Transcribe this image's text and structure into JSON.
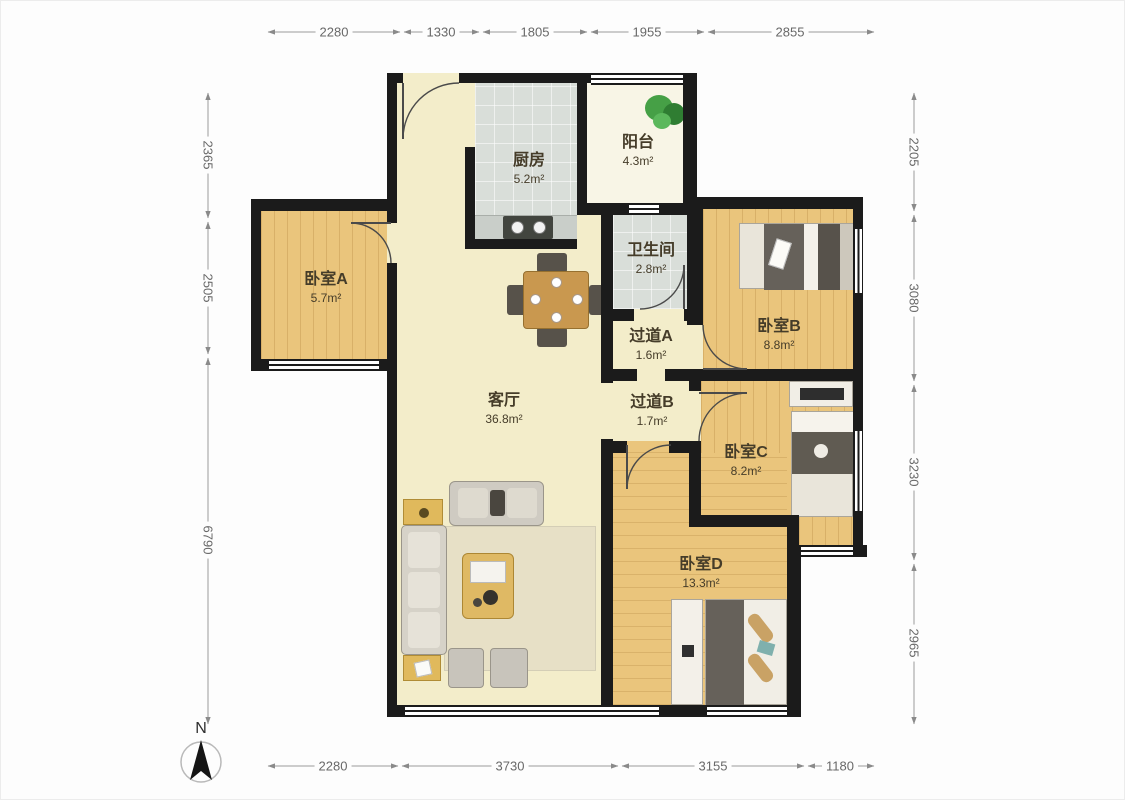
{
  "title": "apartment-floor-plan",
  "compass": {
    "label": "N"
  },
  "dimensions": {
    "top": [
      "2280",
      "1330",
      "1805",
      "1955",
      "2855"
    ],
    "bottom": [
      "2280",
      "3730",
      "3155",
      "1180"
    ],
    "left": [
      "2365",
      "2505",
      "6790"
    ],
    "right": [
      "2205",
      "3080",
      "3230",
      "2965"
    ]
  },
  "rooms": {
    "living": {
      "name": "客厅",
      "area": "36.8m²"
    },
    "kitchen": {
      "name": "厨房",
      "area": "5.2m²"
    },
    "balcony": {
      "name": "阳台",
      "area": "4.3m²"
    },
    "bathroom": {
      "name": "卫生间",
      "area": "2.8m²"
    },
    "hallwayA": {
      "name": "过道A",
      "area": "1.6m²"
    },
    "hallwayB": {
      "name": "过道B",
      "area": "1.7m²"
    },
    "bedroomA": {
      "name": "卧室A",
      "area": "5.7m²"
    },
    "bedroomB": {
      "name": "卧室B",
      "area": "8.8m²"
    },
    "bedroomC": {
      "name": "卧室C",
      "area": "8.2m²"
    },
    "bedroomD": {
      "name": "卧室D",
      "area": "13.3m²"
    }
  },
  "colors": {
    "wall": "#1b1b1b",
    "wood_floor": "#eac57c",
    "living_floor": "#f3edca",
    "tile_floor": "#d9ded9",
    "plant_green": "#3f9b3f",
    "dim_text": "#686868"
  }
}
